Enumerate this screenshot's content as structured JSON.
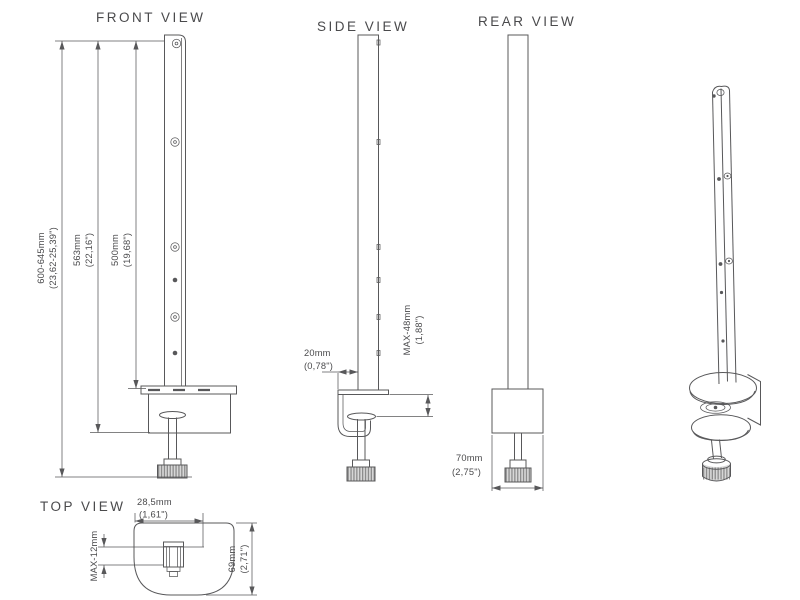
{
  "colors": {
    "background": "#ffffff",
    "line": "#58585a",
    "text": "#4a4a4c"
  },
  "front_view": {
    "title": "FRONT VIEW",
    "overall_height_mm": "600-645mm",
    "overall_height_in": "(23,62-25,39\")",
    "mid_height_mm": "563mm",
    "mid_height_in": "(22,16\")",
    "pole_height_mm": "500mm",
    "pole_height_in": "(19,68\")"
  },
  "side_view": {
    "title": "SIDE VIEW",
    "offset_mm": "20mm",
    "offset_in": "(0,78\")",
    "clamp_range_mm": "MAX-48mm",
    "clamp_range_in": "(1,88\")"
  },
  "rear_view": {
    "title": "REAR VIEW",
    "width_mm": "70mm",
    "width_in": "(2,75\")"
  },
  "top_view": {
    "title": "TOP VIEW",
    "depth_mm": "28,5mm",
    "depth_in": "(1,61\")",
    "edge_max_mm": "MAX-12mm",
    "plate_mm": "69mm",
    "plate_in": "(2,71\")"
  }
}
